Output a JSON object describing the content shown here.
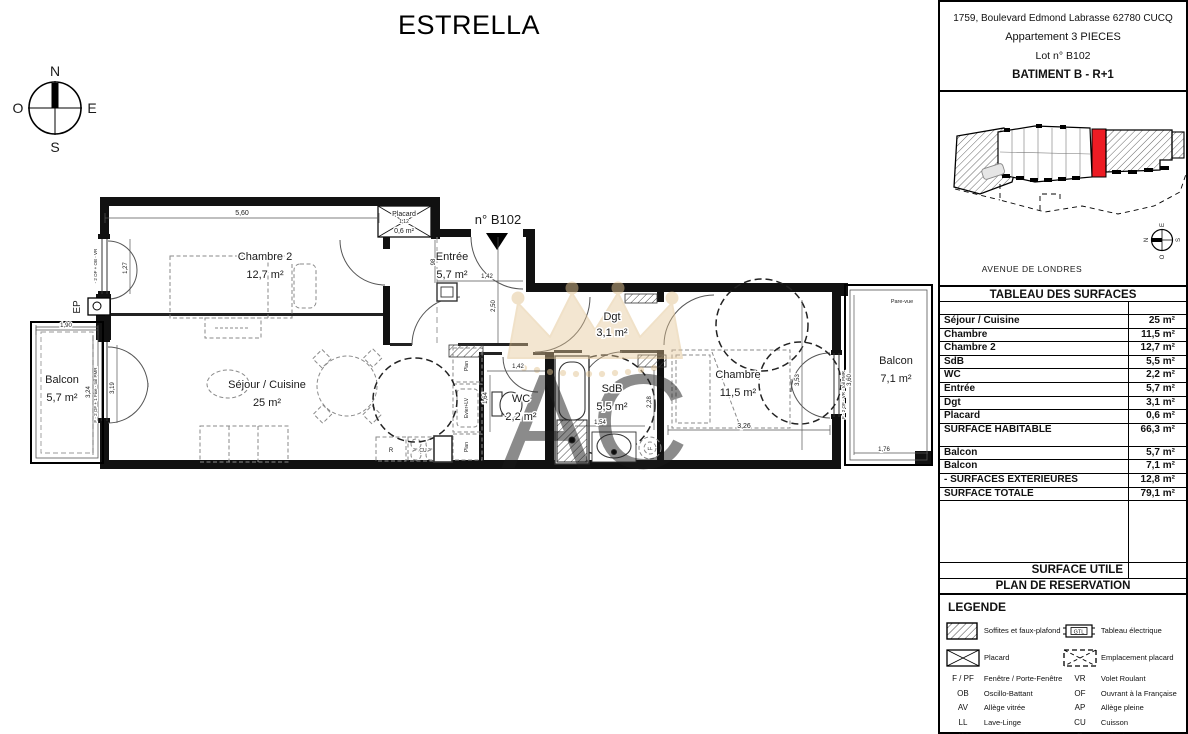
{
  "title": "ESTRELLA",
  "compass": {
    "n": "N",
    "s": "S",
    "e": "E",
    "o": "O"
  },
  "header": {
    "address": "1759, Boulevard Edmond Labrasse 62780 CUCQ",
    "apartment": "Appartement 3 PIECES",
    "lot": "Lot n° B102",
    "building": "BATIMENT B  - R+1"
  },
  "siteplan": {
    "street": "AVENUE DE LONDRES",
    "highlight_color": "#ed1c24",
    "compass": {
      "n": "N",
      "s": "S",
      "e": "E",
      "o": "O"
    }
  },
  "surfaces": {
    "title": "TABLEAU DES SURFACES",
    "rows": [
      {
        "label": "Séjour / Cuisine",
        "value": "25 m²"
      },
      {
        "label": "Chambre",
        "value": "11,5 m²"
      },
      {
        "label": "Chambre 2",
        "value": "12,7 m²"
      },
      {
        "label": "SdB",
        "value": "5,5 m²"
      },
      {
        "label": "WC",
        "value": "2,2 m²"
      },
      {
        "label": "Entrée",
        "value": "5,7 m²"
      },
      {
        "label": "Dgt",
        "value": "3,1 m²"
      },
      {
        "label": "Placard",
        "value": "0,6 m²"
      },
      {
        "label": "SURFACE HABITABLE",
        "value": "66,3 m²"
      },
      {
        "label": "Balcon",
        "value": "5,7 m²"
      },
      {
        "label": "Balcon",
        "value": "7,1 m²"
      },
      {
        "label": "- SURFACES EXTERIEURES",
        "value": "12,8 m²"
      },
      {
        "label": "SURFACE TOTALE",
        "value": "79,1 m²"
      }
    ],
    "surface_utile": "SURFACE UTILE",
    "plan_reservation": "PLAN DE RESERVATION"
  },
  "legend": {
    "title": "LEGENDE",
    "gtl_text": "GTL",
    "symbols": [
      {
        "icon": "hatch",
        "label": "Soffites et faux-plafond"
      },
      {
        "icon": "gtl",
        "label": "Tableau électrique"
      },
      {
        "icon": "placard",
        "label": "Placard"
      },
      {
        "icon": "placard-dashed",
        "label": "Emplacement placard"
      }
    ],
    "abbreviations": [
      {
        "abbr": "F / PF",
        "label": "Fenêtre / Porte-Fenêtre"
      },
      {
        "abbr": "VR",
        "label": "Volet Roulant"
      },
      {
        "abbr": "OB",
        "label": "Oscillo-Battant"
      },
      {
        "abbr": "OF",
        "label": "Ouvrant à la Française"
      },
      {
        "abbr": "AV",
        "label": "Allège vitrée"
      },
      {
        "abbr": "AP",
        "label": "Allège pleine"
      },
      {
        "abbr": "LL",
        "label": "Lave-Linge"
      },
      {
        "abbr": "CU",
        "label": "Cuisson"
      },
      {
        "abbr": "LV",
        "label": "Lave-Vaisselle"
      },
      {
        "abbr": "R",
        "label": "Réfrigérateur"
      }
    ]
  },
  "plan": {
    "unit_label": "n° B102",
    "rooms": [
      {
        "name": "Chambre 2",
        "area": "12,7 m²"
      },
      {
        "name": "Entrée",
        "area": "5,7 m²"
      },
      {
        "name": "Placard",
        "area": "0,6 m²"
      },
      {
        "name": "Séjour / Cuisine",
        "area": "25 m²"
      },
      {
        "name": "WC",
        "area": "2,2 m²"
      },
      {
        "name": "SdB",
        "area": "5,5 m²"
      },
      {
        "name": "Dgt",
        "area": "3,1 m²"
      },
      {
        "name": "Chambre",
        "area": "11,5 m²"
      },
      {
        "name": "Balcon",
        "area": "5,7 m²"
      },
      {
        "name": "Balcon",
        "area": "7,1 m²"
      }
    ],
    "fixtures": {
      "ep": "EP",
      "pare_vue": "Pare-vue",
      "r": "R",
      "cu": "CU",
      "ll": "LL",
      "evier": "Evier+LV",
      "plan_label": "Plan",
      "spec_left": "- 2 OF + OB - VR",
      "spec_balcony": "F - 2 OF + 1 Fixe - toil PMR",
      "spec_right": "F - 2 OF - VR - toil PMR"
    },
    "dims": [
      "5,60",
      "1,12",
      "98",
      "1,42",
      "2,50",
      "1,27",
      "1,90",
      "3,24",
      "3,19",
      "1,42",
      "1,64",
      "1,54",
      "2,28",
      "3,26",
      "3,53",
      "3,60",
      "1,76"
    ]
  },
  "watermark": {
    "monogram": "AC",
    "color": "#e3c493"
  }
}
